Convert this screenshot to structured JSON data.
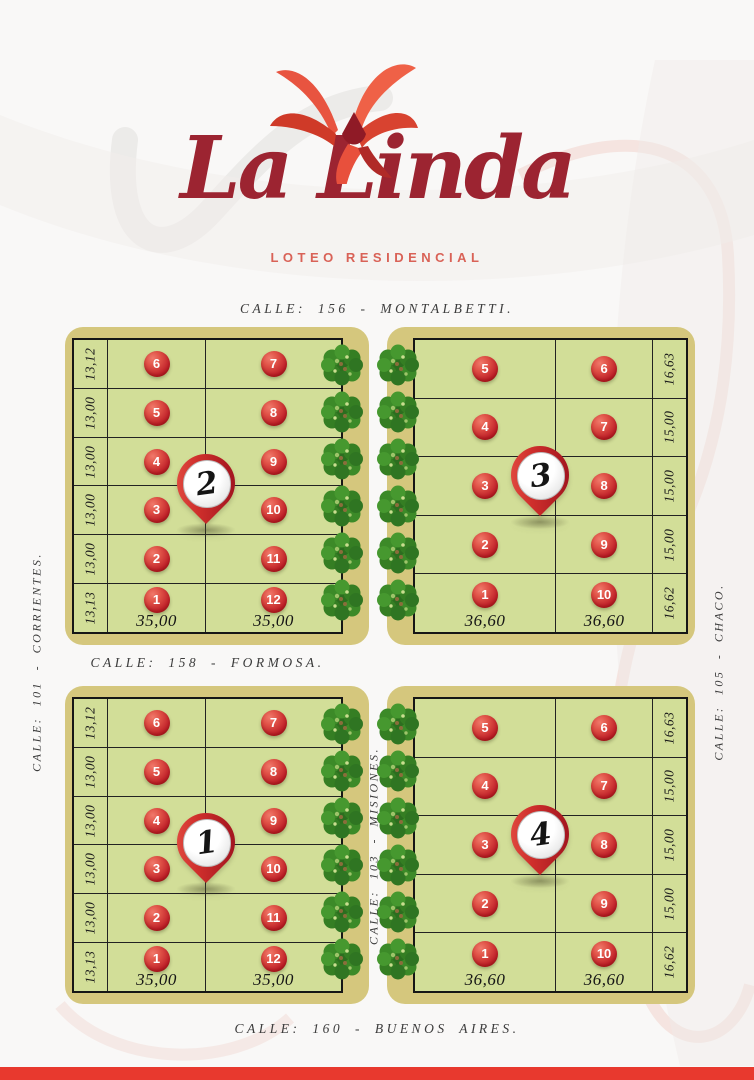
{
  "logo": {
    "title": "La Linda",
    "subtitle": "LOTEO RESIDENCIAL"
  },
  "streets": {
    "top": "CALLE: 156 - MONTALBETTI.",
    "middle": "CALLE: 158 - FORMOSA.",
    "bottom": "CALLE: 160 - BUENOS AIRES.",
    "left": "CALLE: 101 - CORRIENTES.",
    "right": "CALLE: 105 - CHACO.",
    "center": "CALLE: 103 - MISIONES."
  },
  "blocks": [
    {
      "pin": "2",
      "side_measures": [
        "13,12",
        "13,00",
        "13,00",
        "13,00",
        "13,00",
        "13,13"
      ],
      "col1_lots": [
        "6",
        "5",
        "4",
        "3",
        "2",
        "1"
      ],
      "col2_lots": [
        "7",
        "8",
        "9",
        "10",
        "11",
        "12"
      ],
      "bottom_measures": [
        "35,00",
        "35,00"
      ]
    },
    {
      "pin": "3",
      "side_measures": [
        "16,63",
        "15,00",
        "15,00",
        "15,00",
        "16,62"
      ],
      "col1_lots": [
        "5",
        "4",
        "3",
        "2",
        "1"
      ],
      "col2_lots": [
        "6",
        "7",
        "8",
        "9",
        "10"
      ],
      "bottom_measures": [
        "36,60",
        "36,60"
      ]
    },
    {
      "pin": "1",
      "side_measures": [
        "13,12",
        "13,00",
        "13,00",
        "13,00",
        "13,00",
        "13,13"
      ],
      "col1_lots": [
        "6",
        "5",
        "4",
        "3",
        "2",
        "1"
      ],
      "col2_lots": [
        "7",
        "8",
        "9",
        "10",
        "11",
        "12"
      ],
      "bottom_measures": [
        "35,00",
        "35,00"
      ]
    },
    {
      "pin": "4",
      "side_measures": [
        "16,63",
        "15,00",
        "15,00",
        "15,00",
        "16,62"
      ],
      "col1_lots": [
        "5",
        "4",
        "3",
        "2",
        "1"
      ],
      "col2_lots": [
        "6",
        "7",
        "8",
        "9",
        "10"
      ],
      "bottom_measures": [
        "36,60",
        "36,60"
      ]
    }
  ],
  "icons": {
    "logo_flower": "ceibo-flower-icon",
    "block_marker": "map-pin-icon",
    "greenery": "bush-icon"
  },
  "palette": {
    "logo_red": "#9c2431",
    "subtitle_red": "#d96257",
    "accent_red": "#e8392e",
    "frame_khaki": "#d5c77d",
    "lot_green": "#d2de98",
    "badge_red": "#c0222a",
    "tree_green": "#3c8a28",
    "street_text": "#3c3c3c"
  }
}
